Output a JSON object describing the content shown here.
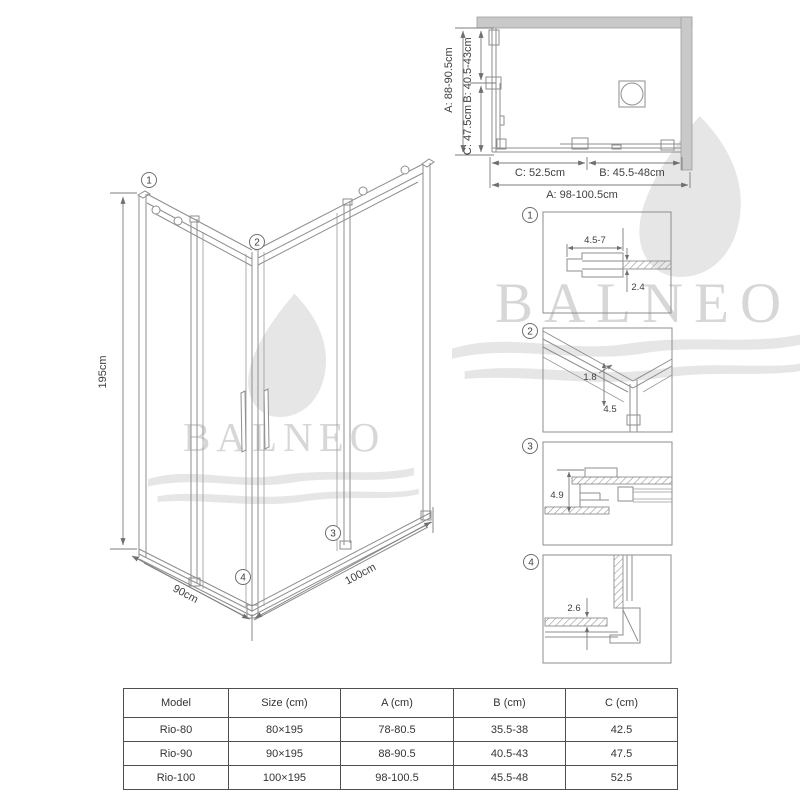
{
  "brand": {
    "watermark": "BALNEO"
  },
  "plan_view": {
    "dim_a_vertical": "A: 88-90.5cm",
    "dim_b_vertical": "B: 40.5-43cm",
    "dim_c_vertical": "C: 47.5cm",
    "dim_c_horizontal": "C: 52.5cm",
    "dim_b_horizontal": "B: 45.5-48cm",
    "dim_a_horizontal": "A: 98-100.5cm"
  },
  "isometric": {
    "height_label": "195cm",
    "left_width_label": "90cm",
    "right_width_label": "100cm",
    "callout_1": "1",
    "callout_2": "2",
    "callout_3": "3",
    "callout_4": "4"
  },
  "details": [
    {
      "number": "1",
      "dim_1": "4.5-7",
      "dim_2": "2.4"
    },
    {
      "number": "2",
      "dim_1": "1.8",
      "dim_2": "4.5"
    },
    {
      "number": "3",
      "dim_1": "4.9"
    },
    {
      "number": "4",
      "dim_1": "2.6"
    }
  ],
  "table": {
    "headers": [
      "Model",
      "Size (cm)",
      "A (cm)",
      "B (cm)",
      "C (cm)"
    ],
    "rows": [
      [
        "Rio-80",
        "80×195",
        "78-80.5",
        "35.5-38",
        "42.5"
      ],
      [
        "Rio-90",
        "90×195",
        "88-90.5",
        "40.5-43",
        "47.5"
      ],
      [
        "Rio-100",
        "100×195",
        "98-100.5",
        "45.5-48",
        "52.5"
      ]
    ]
  }
}
